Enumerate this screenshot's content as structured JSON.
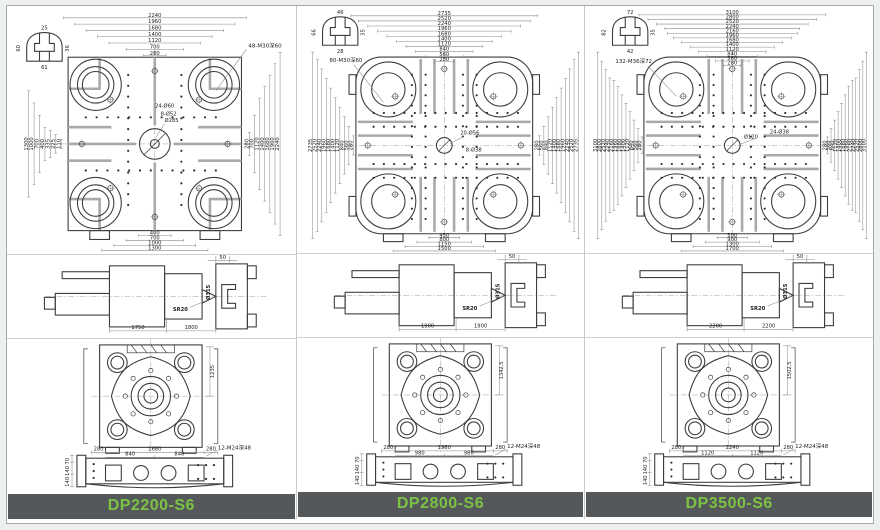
{
  "colors": {
    "footer_bg": "#54585b",
    "model_text": "#7cc244",
    "drawing_line": "#3c3c3c",
    "tslot_gray": "#a9a9a9"
  },
  "machines": [
    {
      "name": "DP2200-S6",
      "top_view": {
        "thread_label": "48-M30深60",
        "dims_main": [
          "2240",
          "1960",
          "1680",
          "1400",
          "1120",
          "700",
          "280"
        ],
        "dims_chain": [
          "400",
          "700",
          "1000",
          "1300"
        ],
        "dims_left": [
          "1300",
          "1000",
          "700",
          "400",
          "335",
          "225",
          "110"
        ],
        "center_labels": {
          "l1": "24-Ø60",
          "l2": "8-Ø52",
          "l3": "Ø285"
        },
        "slot_detail": {
          "top": "25",
          "left": "60",
          "bottom": "61",
          "right": "36"
        }
      },
      "side_view": {
        "top": "50",
        "bore": "Ø315",
        "sphere": "SR20",
        "dim_left": "1750",
        "dim_right": "1800"
      },
      "bottom_view": {
        "height_dim": "1235",
        "chain_outer": [
          "280",
          "1680",
          "280"
        ],
        "chain_inner": [
          "840",
          "840"
        ],
        "thread_label": "12-M24深48",
        "side_dims": [
          "70",
          "140",
          "140"
        ]
      }
    },
    {
      "name": "DP2800-S6",
      "top_view": {
        "thread_label": "80-M30深60",
        "dims_main": [
          "2735",
          "2520",
          "2240",
          "1960",
          "1680",
          "1400",
          "1120",
          "840",
          "560",
          "280"
        ],
        "dims_chain": [
          "450",
          "800",
          "1150",
          "1500"
        ],
        "center_labels": {
          "l1": "20-Ø56",
          "l2": "8-Ø38",
          "l3": ""
        },
        "slot_detail": {
          "top": "46",
          "left": "66",
          "bottom": "28",
          "right": "35"
        }
      },
      "side_view": {
        "top": "50",
        "bore": "Ø315",
        "sphere": "SR20",
        "dim_left": "1900",
        "dim_right": "1900"
      },
      "bottom_view": {
        "height_dim": "1342.5",
        "chain_outer": [
          "280",
          "1960",
          "280"
        ],
        "chain_inner": [
          "980",
          "980"
        ],
        "thread_label": "12-M24深48",
        "side_dims": [
          "70",
          "140",
          "140"
        ]
      }
    },
    {
      "name": "DP3500-S6",
      "top_view": {
        "thread_label": "132-M36深72",
        "dims_main": [
          "3100",
          "2800",
          "2520",
          "2240",
          "2160",
          "1960",
          "1680",
          "1400",
          "1120",
          "840",
          "560",
          "280"
        ],
        "dims_chain": [
          "500",
          "900",
          "1300",
          "1700"
        ],
        "center_labels": {
          "l1": "Ø120",
          "l2": "24-Ø38",
          "l3": ""
        },
        "slot_detail": {
          "top": "72",
          "left": "82",
          "bottom": "42",
          "right": "35"
        }
      },
      "side_view": {
        "top": "50",
        "bore": "Ø315",
        "sphere": "SR20",
        "dim_left": "2200",
        "dim_right": "2200"
      },
      "bottom_view": {
        "height_dim": "1502.5",
        "chain_outer": [
          "280",
          "2240",
          "280"
        ],
        "chain_inner": [
          "1120",
          "1120"
        ],
        "thread_label": "12-M24深48",
        "side_dims": [
          "70",
          "140",
          "140"
        ]
      }
    }
  ]
}
